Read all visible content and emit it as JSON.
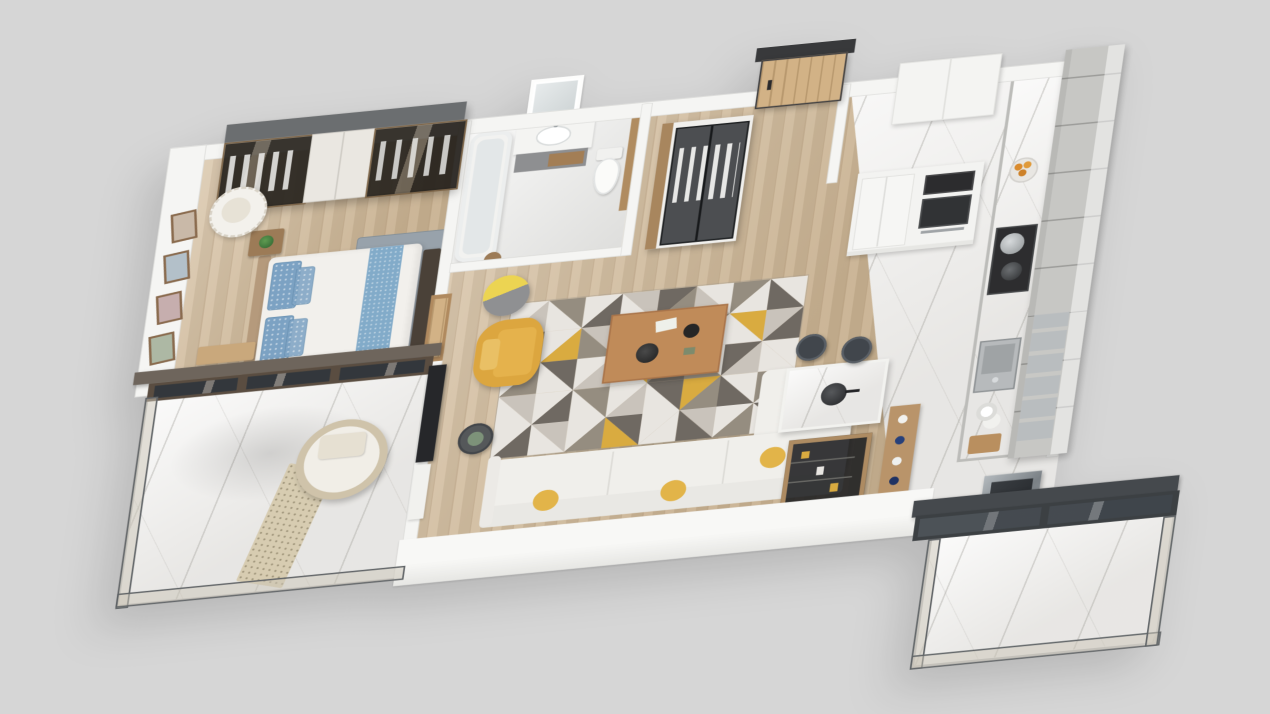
{
  "scene": {
    "type": "isometric-3d-floor-plan-render",
    "description": "3D rendered floor plan of a one-bedroom apartment, viewed from above at an angle on a plain gray background. No visible text.",
    "background_color": "#d6d6d6"
  },
  "palette": {
    "background": "#d6d6d6",
    "wall_white": "#f5f5f3",
    "wood_floor": "#d0b896",
    "marble_floor": "#efeeec",
    "dark_wardrobe_glass": "#2b2archive",
    "wardrobe_top_gray": "#6b6e70",
    "accent_yellow": "#dca63f",
    "bed_blue": "#7ca2c3",
    "cabinet_gray": "#c7c7c4",
    "appliance_dark": "#2d2d2f",
    "plant_green": "#478041",
    "wood_furniture": "#b08a5f",
    "railing_frame": "#5f6366",
    "balcony_door_brown": "#5a4d41"
  },
  "rooms": [
    {
      "name": "bedroom",
      "floor": "wood",
      "furniture": [
        "mirrored-wardrobe",
        "double-bed-with-blue-bedding",
        "headboard",
        "foot-bench",
        "nightstand-with-plant",
        "hanging-rattan-chair",
        "wall-picture-frames",
        "gray-blue-area-rug",
        "wood-bench"
      ]
    },
    {
      "name": "bedroom-balcony",
      "floor": "marble",
      "furniture": [
        "round-daybed-lounger",
        "dotted-runner-rug",
        "potted-plant-large",
        "potted-plant-small",
        "potted-plant-floor",
        "glass-railing",
        "dark-framed-sliding-glass-door"
      ]
    },
    {
      "name": "bathroom",
      "floor": "tile",
      "furniture": [
        "bathtub",
        "vanity-with-mirror",
        "sink",
        "toilet",
        "wood-partition"
      ]
    },
    {
      "name": "hallway-entry",
      "floor": "wood",
      "furniture": [
        "glass-door-closet-with-clothes",
        "wooden-entry-door-dark-frame"
      ]
    },
    {
      "name": "living-room",
      "floor": "wood",
      "furniture": [
        "geometric-triangle-rug",
        "yellow-armchair",
        "drum-floor-lamp",
        "wood-coffee-table",
        "l-shaped-white-sofa",
        "yellow-throw-pillows",
        "round-side-table",
        "wall-mounted-tv",
        "tv-cabinet",
        "potted-plant",
        "wood-sideboard-with-bottles",
        "dark-display-cabinet"
      ]
    },
    {
      "name": "kitchen",
      "floor": "marble",
      "furniture": [
        "gray-shaker-cabinet-run",
        "white-tall-units-fridge-oven-microwave",
        "white-upper-cabinets",
        "counter-with-cooktop-and-pots",
        "stainless-sink",
        "fruit-bowl",
        "kitchen-island-with-wok",
        "two-dark-bar-stools",
        "stainless-appliance"
      ]
    },
    {
      "name": "kitchen-balcony",
      "floor": "marble",
      "furniture": [
        "glass-railing",
        "dark-sliding-glass-door",
        "potted-plant"
      ]
    }
  ],
  "living_room_rug": {
    "type": "triangle-pattern",
    "cols": 8,
    "rows": 5,
    "cell_w": 46,
    "cell_h": 44,
    "colors": [
      "#e8e5e0",
      "#c9c3bb",
      "#958d80",
      "#6f6962",
      "#d9ab40"
    ],
    "cells": [
      [
        0,
        1
      ],
      [
        2,
        0
      ],
      [
        0,
        3
      ],
      [
        1,
        0
      ],
      [
        3,
        2
      ],
      [
        0,
        1
      ],
      [
        2,
        0
      ],
      [
        0,
        3
      ],
      [
        3,
        0
      ],
      [
        0,
        4
      ],
      [
        1,
        2
      ],
      [
        0,
        3
      ],
      [
        0,
        1
      ],
      [
        2,
        0
      ],
      [
        4,
        0
      ],
      [
        1,
        3
      ],
      [
        0,
        2
      ],
      [
        3,
        0
      ],
      [
        0,
        1
      ],
      [
        4,
        0
      ],
      [
        2,
        3
      ],
      [
        0,
        2
      ],
      [
        3,
        1
      ],
      [
        0,
        0
      ],
      [
        1,
        0
      ],
      [
        0,
        3
      ],
      [
        2,
        0
      ],
      [
        0,
        1
      ],
      [
        3,
        0
      ],
      [
        4,
        2
      ],
      [
        0,
        3
      ],
      [
        2,
        0
      ],
      [
        0,
        3
      ],
      [
        1,
        0
      ],
      [
        0,
        2
      ],
      [
        3,
        4
      ],
      [
        0,
        0
      ],
      [
        1,
        3
      ],
      [
        0,
        2
      ],
      [
        3,
        0
      ]
    ]
  }
}
